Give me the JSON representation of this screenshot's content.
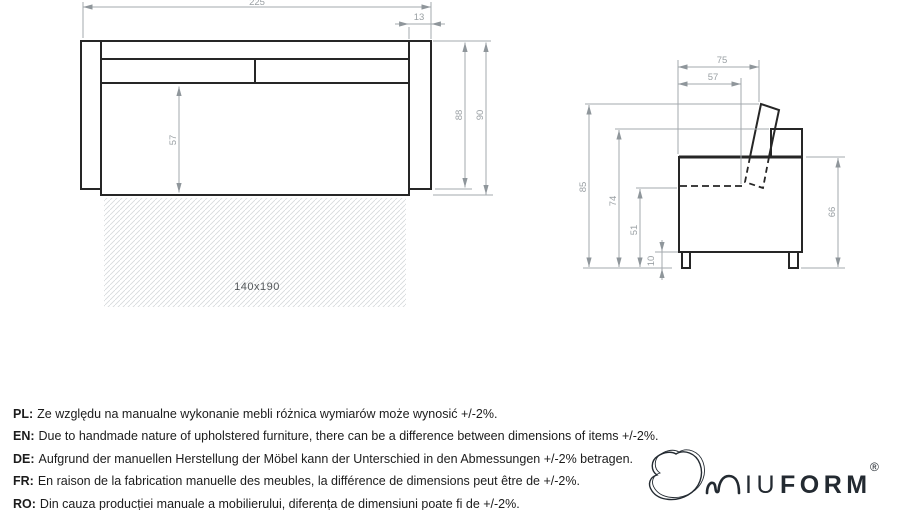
{
  "front_view": {
    "dims": {
      "total_width": "225",
      "armrest_width": "13",
      "seat_height": "57",
      "height_to_armrest_bottom": "88",
      "total_height": "90"
    },
    "mattress_label": "140x190"
  },
  "side_view": {
    "dims": {
      "depth_total": "75",
      "seat_depth": "57",
      "total_height": "85",
      "back_height": "74",
      "seat_level_height": "51",
      "leg_height": "10",
      "side_height": "66"
    }
  },
  "notes": [
    {
      "label": "PL:",
      "text": "Ze względu na manualne wykonanie mebli różnica wymiarów może wynosić +/-2%."
    },
    {
      "label": "EN:",
      "text": "Due to handmade nature of upholstered furniture, there can be a difference between dimensions of items +/-2%."
    },
    {
      "label": "DE:",
      "text": "Aufgrund der manuellen Herstellung der Möbel kann der Unterschied in den Abmessungen +/-2% betragen."
    },
    {
      "label": "FR:",
      "text": "En raison de la fabrication manuelle des meubles, la différence de dimensions peut être de +/-2%."
    },
    {
      "label": "RO:",
      "text": "Din cauza producției manuale a mobilierului, diferența de dimensiuni poate fi de +/-2%."
    }
  ],
  "logo": {
    "iu": "IU",
    "form": "FORM",
    "registered": "®"
  },
  "colors": {
    "outline": "#262626",
    "dimension": "#a3a9ad",
    "dimension_text": "#9aa0a4",
    "hatch": "#d5d9db",
    "note_text": "#1c1c1c",
    "logo": "#232a31"
  }
}
